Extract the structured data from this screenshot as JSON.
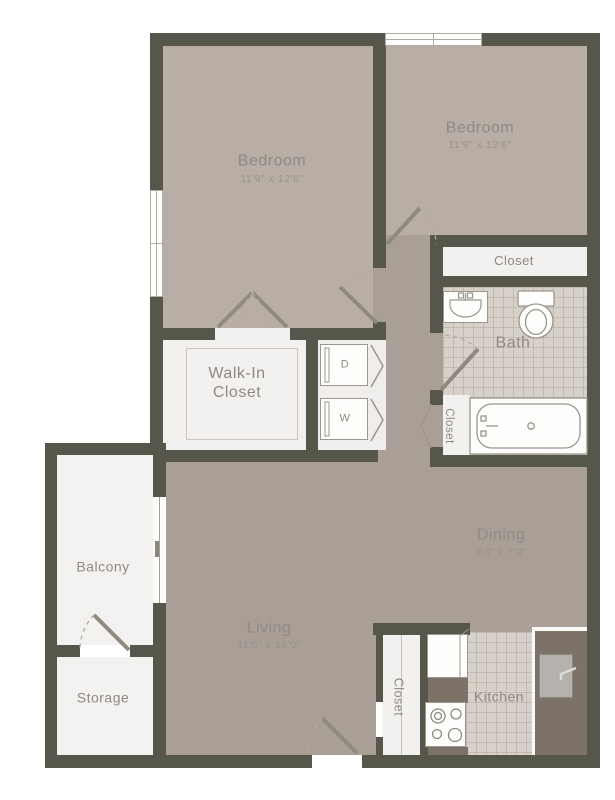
{
  "rooms": {
    "bedroom_left": {
      "name": "Bedroom",
      "dimensions": "11'9\" x 12'6\""
    },
    "bedroom_right": {
      "name": "Bedroom",
      "dimensions": "11'9\" x 12'6\""
    },
    "closet_top": {
      "name": "Closet"
    },
    "bath": {
      "name": "Bath"
    },
    "bath_linen_closet": {
      "name": "Closet"
    },
    "walk_in_closet": {
      "name": "Walk-In Closet"
    },
    "laundry": {
      "dryer_label": "D",
      "washer_label": "W"
    },
    "dining": {
      "name": "Dining",
      "dimensions": "9'4\" x 7'0\""
    },
    "living": {
      "name": "Living",
      "dimensions": "11'0\" x 16'0\""
    },
    "balcony": {
      "name": "Balcony"
    },
    "storage": {
      "name": "Storage"
    },
    "hall_closet": {
      "name": "Closet"
    },
    "kitchen": {
      "name": "Kitchen"
    }
  },
  "colors": {
    "wall": "#57564a",
    "floor_main": "#a99f96",
    "floor_bedroom": "#b8aea6",
    "floor_white": "#f2f1ef",
    "tile": "#d7d1c9",
    "counter": "#7c7267",
    "text": "#8e8983",
    "text_dim": "#97928b",
    "fixture": "#9b968e"
  }
}
